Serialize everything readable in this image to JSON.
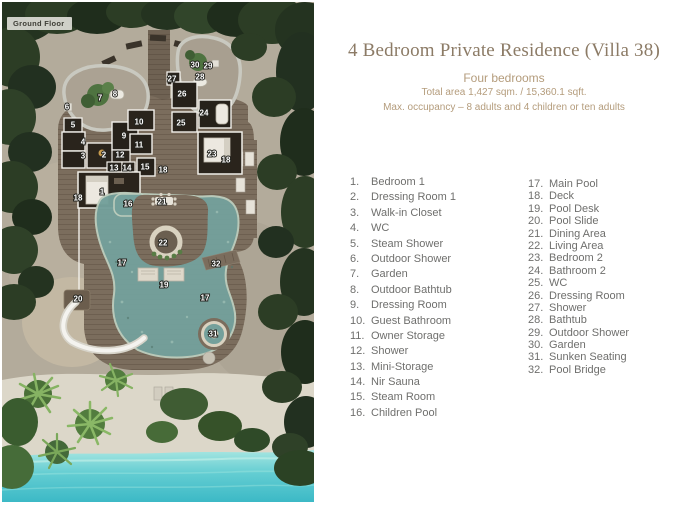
{
  "header": {
    "title": "4 Bedroom Private Residence (Villa 38)",
    "subtitle": "Four bedrooms",
    "area_line": "Total area 1,427 sqm. / 15,360.1 sqft.",
    "occupancy_line": "Max. occupancy – 8 adults and 4 children or ten adults"
  },
  "plan": {
    "ground_floor_label": "Ground Floor",
    "markers": [
      {
        "n": "1",
        "x": 100,
        "y": 190
      },
      {
        "n": "2",
        "x": 102,
        "y": 153
      },
      {
        "n": "3",
        "x": 81,
        "y": 154
      },
      {
        "n": "4",
        "x": 81,
        "y": 140
      },
      {
        "n": "5",
        "x": 71,
        "y": 123
      },
      {
        "n": "6",
        "x": 65,
        "y": 105
      },
      {
        "n": "7",
        "x": 98,
        "y": 96
      },
      {
        "n": "8",
        "x": 113,
        "y": 92
      },
      {
        "n": "9",
        "x": 122,
        "y": 134
      },
      {
        "n": "10",
        "x": 137,
        "y": 120
      },
      {
        "n": "11",
        "x": 137,
        "y": 143
      },
      {
        "n": "12",
        "x": 118,
        "y": 153
      },
      {
        "n": "13",
        "x": 112,
        "y": 166
      },
      {
        "n": "14",
        "x": 125,
        "y": 166
      },
      {
        "n": "15",
        "x": 143,
        "y": 165
      },
      {
        "n": "16",
        "x": 126,
        "y": 202
      },
      {
        "n": "17",
        "x": 120,
        "y": 261
      },
      {
        "n": "17",
        "x": 203,
        "y": 296
      },
      {
        "n": "18",
        "x": 76,
        "y": 196
      },
      {
        "n": "18",
        "x": 161,
        "y": 168
      },
      {
        "n": "18",
        "x": 224,
        "y": 158
      },
      {
        "n": "19",
        "x": 162,
        "y": 283
      },
      {
        "n": "20",
        "x": 76,
        "y": 297
      },
      {
        "n": "21",
        "x": 160,
        "y": 200
      },
      {
        "n": "22",
        "x": 161,
        "y": 241
      },
      {
        "n": "23",
        "x": 210,
        "y": 152
      },
      {
        "n": "24",
        "x": 202,
        "y": 111
      },
      {
        "n": "25",
        "x": 179,
        "y": 121
      },
      {
        "n": "26",
        "x": 180,
        "y": 92
      },
      {
        "n": "27",
        "x": 170,
        "y": 77
      },
      {
        "n": "28",
        "x": 198,
        "y": 75
      },
      {
        "n": "29",
        "x": 206,
        "y": 64
      },
      {
        "n": "30",
        "x": 193,
        "y": 63
      },
      {
        "n": "31",
        "x": 211,
        "y": 332
      },
      {
        "n": "32",
        "x": 214,
        "y": 262
      }
    ],
    "colors": {
      "sand": "#b3ab9b",
      "beach": "#dcd7c9",
      "water": "#45c2cb",
      "foliage": "#2b3a27",
      "deck": "#7b6d5d",
      "pool": "#74a09b",
      "slide": "#eceae3",
      "walls": "#f2f0ea"
    }
  },
  "legend": {
    "column1": [
      {
        "num": "1.",
        "label": "Bedroom 1"
      },
      {
        "num": "2.",
        "label": "Dressing Room 1"
      },
      {
        "num": "3.",
        "label": "Walk-in Closet"
      },
      {
        "num": "4.",
        "label": "WC"
      },
      {
        "num": "5.",
        "label": "Steam Shower"
      },
      {
        "num": "6.",
        "label": "Outdoor Shower"
      },
      {
        "num": "7.",
        "label": "Garden"
      },
      {
        "num": "8.",
        "label": "Outdoor Bathtub"
      },
      {
        "num": "9.",
        "label": "Dressing Room"
      },
      {
        "num": "10.",
        "label": "Guest Bathroom"
      },
      {
        "num": "11.",
        "label": "Owner Storage"
      },
      {
        "num": "12.",
        "label": "Shower"
      },
      {
        "num": "13.",
        "label": "Mini-Storage"
      },
      {
        "num": "14.",
        "label": "Nir Sauna"
      },
      {
        "num": "15.",
        "label": "Steam Room"
      },
      {
        "num": "16.",
        "label": "Children Pool"
      }
    ],
    "column2": [
      {
        "num": "17.",
        "label": "Main Pool"
      },
      {
        "num": "18.",
        "label": "Deck"
      },
      {
        "num": "19.",
        "label": "Pool Desk"
      },
      {
        "num": "20.",
        "label": "Pool Slide"
      },
      {
        "num": "21.",
        "label": "Dining Area"
      },
      {
        "num": "22.",
        "label": "Living Area"
      },
      {
        "num": "23.",
        "label": "Bedroom 2"
      },
      {
        "num": "24.",
        "label": "Bathroom 2"
      },
      {
        "num": "25.",
        "label": "WC"
      },
      {
        "num": "26.",
        "label": "Dressing Room"
      },
      {
        "num": "27.",
        "label": "Shower"
      },
      {
        "num": "28.",
        "label": "Bathtub"
      },
      {
        "num": "29.",
        "label": "Outdoor Shower"
      },
      {
        "num": "30.",
        "label": "Garden"
      },
      {
        "num": "31.",
        "label": "Sunken Seating"
      },
      {
        "num": "32.",
        "label": "Pool Bridge"
      }
    ]
  }
}
